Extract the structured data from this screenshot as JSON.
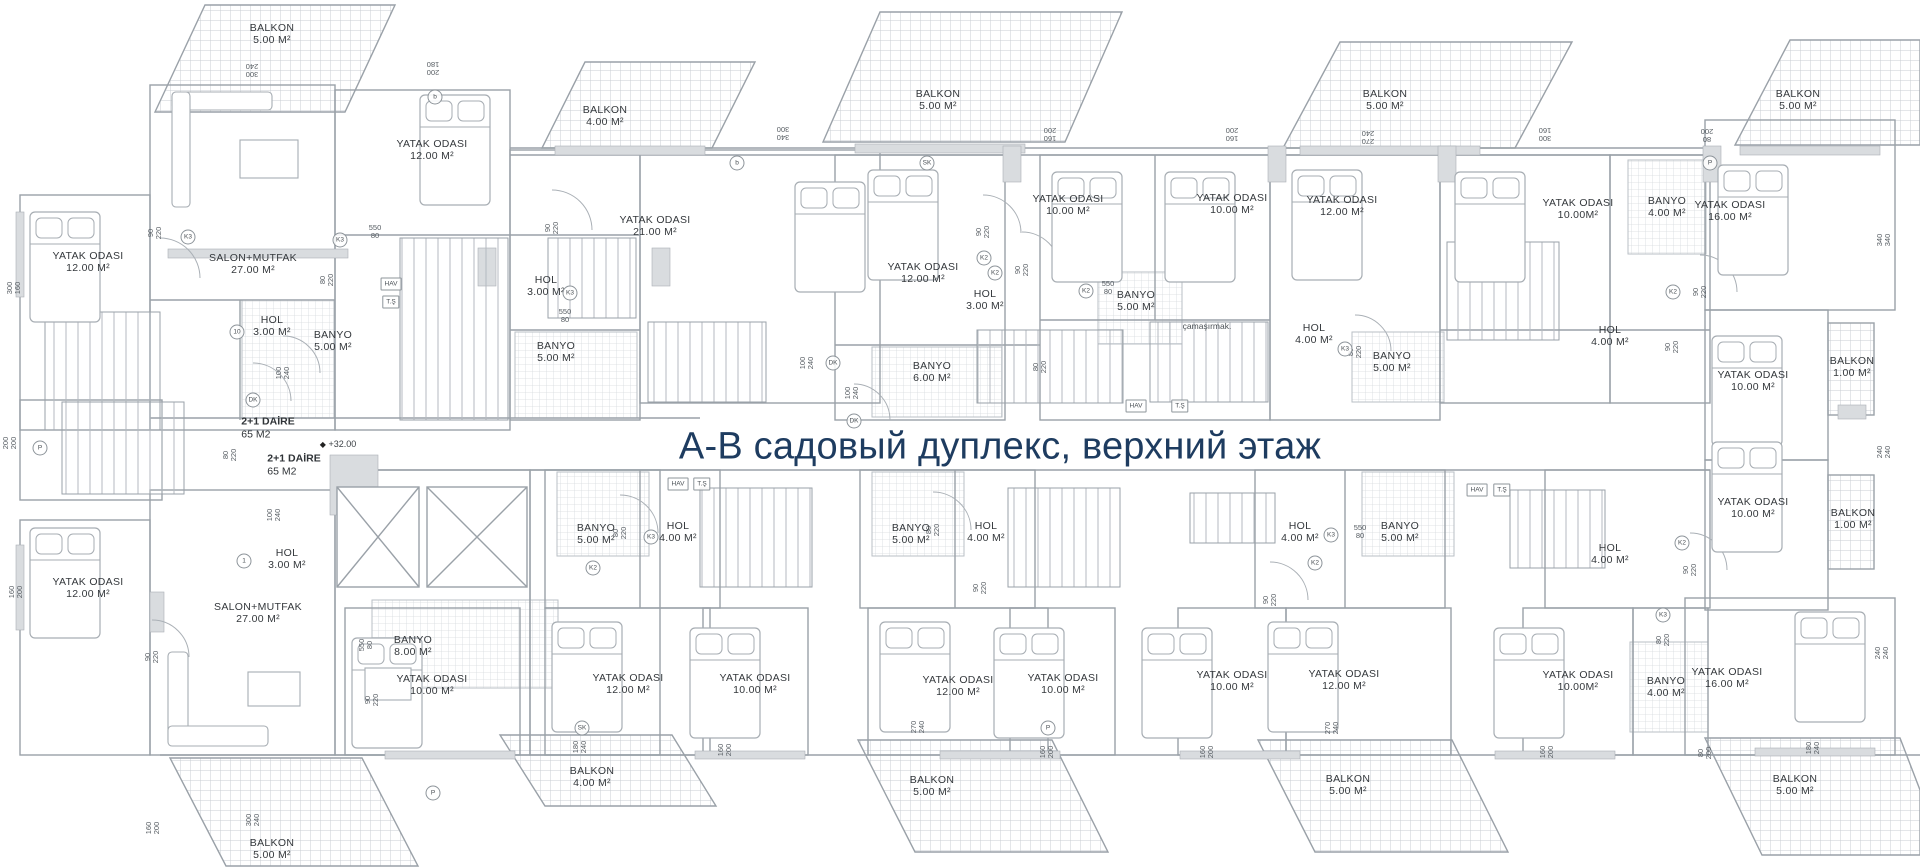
{
  "title": {
    "text": "А-В садовый дуплекс, верхний этаж",
    "color": "#1e3c60"
  },
  "plan": {
    "line_color": "#9aa1a8",
    "hatch_color": "#c9ced3",
    "rooms": [
      {
        "name": "BALKON",
        "area": "5.00 M²",
        "x": 272,
        "y": 34
      },
      {
        "name": "YATAK ODASI",
        "area": "12.00 M²",
        "x": 432,
        "y": 150
      },
      {
        "name": "BALKON",
        "area": "4.00 M²",
        "x": 605,
        "y": 116
      },
      {
        "name": "YATAK ODASI",
        "area": "21.00 M²",
        "x": 655,
        "y": 226
      },
      {
        "name": "YATAK ODASI",
        "area": "12.00 M²",
        "x": 88,
        "y": 262
      },
      {
        "name": "SALON+MUTFAK",
        "area": "27.00 M²",
        "x": 253,
        "y": 264
      },
      {
        "name": "HOL",
        "area": "3.00 M²",
        "x": 272,
        "y": 326
      },
      {
        "name": "BANYO",
        "area": "5.00 M²",
        "x": 333,
        "y": 341
      },
      {
        "name": "HOL",
        "area": "3.00 M²",
        "x": 546,
        "y": 286
      },
      {
        "name": "BANYO",
        "area": "5.00 M²",
        "x": 556,
        "y": 352
      },
      {
        "name": "BALKON",
        "area": "5.00 M²",
        "x": 938,
        "y": 100
      },
      {
        "name": "YATAK ODASI",
        "area": "12.00 M²",
        "x": 923,
        "y": 273
      },
      {
        "name": "HOL",
        "area": "3.00 M²",
        "x": 985,
        "y": 300
      },
      {
        "name": "BANYO",
        "area": "6.00 M²",
        "x": 932,
        "y": 372
      },
      {
        "name": "YATAK ODASI",
        "area": "10.00 M²",
        "x": 1068,
        "y": 205
      },
      {
        "name": "YATAK ODASI",
        "area": "10.00 M²",
        "x": 1232,
        "y": 204
      },
      {
        "name": "BANYO",
        "area": "5.00 M²",
        "x": 1136,
        "y": 301
      },
      {
        "name": "BALKON",
        "area": "5.00 M²",
        "x": 1385,
        "y": 100
      },
      {
        "name": "YATAK ODASI",
        "area": "12.00 M²",
        "x": 1342,
        "y": 206
      },
      {
        "name": "HOL",
        "area": "4.00 M²",
        "x": 1314,
        "y": 334
      },
      {
        "name": "BANYO",
        "area": "5.00 M²",
        "x": 1392,
        "y": 362
      },
      {
        "name": "YATAK ODASI",
        "area": "10.00M²",
        "x": 1578,
        "y": 209
      },
      {
        "name": "BANYO",
        "area": "4.00 M²",
        "x": 1667,
        "y": 207
      },
      {
        "name": "YATAK ODASI",
        "area": "16.00 M²",
        "x": 1730,
        "y": 211
      },
      {
        "name": "BALKON",
        "area": "5.00 M²",
        "x": 1798,
        "y": 100
      },
      {
        "name": "HOL",
        "area": "4.00 M²",
        "x": 1610,
        "y": 336
      },
      {
        "name": "YATAK ODASI",
        "area": "10.00 M²",
        "x": 1753,
        "y": 381
      },
      {
        "name": "BALKON",
        "area": "1.00 M²",
        "x": 1852,
        "y": 367
      },
      {
        "name": "YATAK ODASI",
        "area": "10.00 M²",
        "x": 1753,
        "y": 508
      },
      {
        "name": "BALKON",
        "area": "1.00 M²",
        "x": 1853,
        "y": 519
      },
      {
        "name": "HOL",
        "area": "3.00 M²",
        "x": 287,
        "y": 559
      },
      {
        "name": "YATAK ODASI",
        "area": "12.00 M²",
        "x": 88,
        "y": 588
      },
      {
        "name": "SALON+MUTFAK",
        "area": "27.00 M²",
        "x": 258,
        "y": 613
      },
      {
        "name": "BANYO",
        "area": "8.00 M²",
        "x": 413,
        "y": 646
      },
      {
        "name": "YATAK ODASI",
        "area": "10.00 M²",
        "x": 432,
        "y": 685
      },
      {
        "name": "BANYO",
        "area": "5.00 M²",
        "x": 596,
        "y": 534
      },
      {
        "name": "HOL",
        "area": "4.00 M²",
        "x": 678,
        "y": 532
      },
      {
        "name": "YATAK ODASI",
        "area": "12.00 M²",
        "x": 628,
        "y": 684
      },
      {
        "name": "YATAK ODASI",
        "area": "10.00 M²",
        "x": 755,
        "y": 684
      },
      {
        "name": "BANYO",
        "area": "5.00 M²",
        "x": 911,
        "y": 534
      },
      {
        "name": "HOL",
        "area": "4.00 M²",
        "x": 986,
        "y": 532
      },
      {
        "name": "YATAK ODASI",
        "area": "12.00 M²",
        "x": 958,
        "y": 686
      },
      {
        "name": "YATAK ODASI",
        "area": "10.00 M²",
        "x": 1063,
        "y": 684
      },
      {
        "name": "HOL",
        "area": "4.00 M²",
        "x": 1300,
        "y": 532
      },
      {
        "name": "BANYO",
        "area": "5.00 M²",
        "x": 1400,
        "y": 532
      },
      {
        "name": "YATAK ODASI",
        "area": "10.00 M²",
        "x": 1232,
        "y": 681
      },
      {
        "name": "YATAK ODASI",
        "area": "12.00 M²",
        "x": 1344,
        "y": 680
      },
      {
        "name": "HOL",
        "area": "4.00 M²",
        "x": 1610,
        "y": 554
      },
      {
        "name": "YATAK ODASI",
        "area": "10.00M²",
        "x": 1578,
        "y": 681
      },
      {
        "name": "BANYO",
        "area": "4.00 M²",
        "x": 1666,
        "y": 687
      },
      {
        "name": "YATAK ODASI",
        "area": "16.00 M²",
        "x": 1727,
        "y": 678
      },
      {
        "name": "BALKON",
        "area": "5.00 M²",
        "x": 272,
        "y": 849
      },
      {
        "name": "BALKON",
        "area": "4.00 M²",
        "x": 592,
        "y": 777
      },
      {
        "name": "BALKON",
        "area": "5.00 M²",
        "x": 932,
        "y": 786
      },
      {
        "name": "BALKON",
        "area": "5.00 M²",
        "x": 1348,
        "y": 785
      },
      {
        "name": "BALKON",
        "area": "5.00 M²",
        "x": 1795,
        "y": 785
      }
    ],
    "units": [
      {
        "label": "2+1 DAİRE",
        "size": "65 M2",
        "x": 268,
        "y": 428
      },
      {
        "label": "2+1 DAİRE",
        "size": "65 M2",
        "x": 294,
        "y": 465
      }
    ],
    "elevation": {
      "symbol": "◆",
      "text": "+32.00",
      "x": 338,
      "y": 444
    },
    "texts": [
      {
        "t": "çamaşırmak.",
        "x": 1207,
        "y": 326
      }
    ],
    "dims": [
      {
        "a": "90",
        "b": "220",
        "x": 155,
        "y": 233,
        "r": "v"
      },
      {
        "a": "550",
        "b": "80",
        "x": 375,
        "y": 232,
        "r": ""
      },
      {
        "a": "80",
        "b": "220",
        "x": 327,
        "y": 280,
        "r": "v"
      },
      {
        "a": "100",
        "b": "240",
        "x": 283,
        "y": 373,
        "r": "v"
      },
      {
        "a": "90",
        "b": "220",
        "x": 552,
        "y": 228,
        "r": "v"
      },
      {
        "a": "550",
        "b": "80",
        "x": 565,
        "y": 316,
        "r": ""
      },
      {
        "a": "100",
        "b": "240",
        "x": 807,
        "y": 363,
        "r": "v"
      },
      {
        "a": "100",
        "b": "240",
        "x": 852,
        "y": 393,
        "r": "v"
      },
      {
        "a": "80",
        "b": "220",
        "x": 1040,
        "y": 367,
        "r": "v"
      },
      {
        "a": "90",
        "b": "220",
        "x": 983,
        "y": 232,
        "r": "v"
      },
      {
        "a": "90",
        "b": "220",
        "x": 1022,
        "y": 270,
        "r": "v"
      },
      {
        "a": "550",
        "b": "80",
        "x": 1108,
        "y": 288,
        "r": ""
      },
      {
        "a": "80",
        "b": "220",
        "x": 1355,
        "y": 352,
        "r": "v"
      },
      {
        "a": "90",
        "b": "220",
        "x": 1672,
        "y": 347,
        "r": "v"
      },
      {
        "a": "90",
        "b": "220",
        "x": 1700,
        "y": 292,
        "r": "v"
      },
      {
        "a": "340",
        "b": "300",
        "x": 783,
        "y": 133,
        "r": "u"
      },
      {
        "a": "300",
        "b": "240",
        "x": 252,
        "y": 70,
        "r": "u"
      },
      {
        "a": "200",
        "b": "180",
        "x": 433,
        "y": 68,
        "r": "u"
      },
      {
        "a": "160",
        "b": "200",
        "x": 1050,
        "y": 134,
        "r": "u"
      },
      {
        "a": "160",
        "b": "200",
        "x": 1232,
        "y": 134,
        "r": "u"
      },
      {
        "a": "270",
        "b": "240",
        "x": 1368,
        "y": 137,
        "r": "u"
      },
      {
        "a": "300",
        "b": "160",
        "x": 1545,
        "y": 134,
        "r": "u"
      },
      {
        "a": "80",
        "b": "200",
        "x": 1707,
        "y": 135,
        "r": "u"
      },
      {
        "a": "300",
        "b": "160",
        "x": 14,
        "y": 288,
        "r": "v"
      },
      {
        "a": "200",
        "b": "200",
        "x": 10,
        "y": 443,
        "r": "v"
      },
      {
        "a": "160",
        "b": "200",
        "x": 16,
        "y": 592,
        "r": "v"
      },
      {
        "a": "340",
        "b": "340",
        "x": 1884,
        "y": 240,
        "r": "v"
      },
      {
        "a": "240",
        "b": "240",
        "x": 1884,
        "y": 452,
        "r": "v"
      },
      {
        "a": "240",
        "b": "240",
        "x": 1882,
        "y": 653,
        "r": "v"
      },
      {
        "a": "90",
        "b": "220",
        "x": 152,
        "y": 657,
        "r": "v"
      },
      {
        "a": "80",
        "b": "220",
        "x": 230,
        "y": 455,
        "r": "v"
      },
      {
        "a": "100",
        "b": "240",
        "x": 274,
        "y": 515,
        "r": "v"
      },
      {
        "a": "550",
        "b": "80",
        "x": 366,
        "y": 645,
        "r": "v"
      },
      {
        "a": "90",
        "b": "220",
        "x": 372,
        "y": 700,
        "r": "v"
      },
      {
        "a": "80",
        "b": "220",
        "x": 620,
        "y": 533,
        "r": "v"
      },
      {
        "a": "80",
        "b": "220",
        "x": 933,
        "y": 530,
        "r": "v"
      },
      {
        "a": "90",
        "b": "220",
        "x": 980,
        "y": 588,
        "r": "v"
      },
      {
        "a": "90",
        "b": "220",
        "x": 1270,
        "y": 600,
        "r": "v"
      },
      {
        "a": "550",
        "b": "80",
        "x": 1360,
        "y": 532,
        "r": ""
      },
      {
        "a": "90",
        "b": "220",
        "x": 1690,
        "y": 570,
        "r": "v"
      },
      {
        "a": "80",
        "b": "220",
        "x": 1663,
        "y": 640,
        "r": "v"
      },
      {
        "a": "300",
        "b": "240",
        "x": 253,
        "y": 820,
        "r": "v"
      },
      {
        "a": "160",
        "b": "200",
        "x": 153,
        "y": 828,
        "r": "v"
      },
      {
        "a": "180",
        "b": "240",
        "x": 580,
        "y": 747,
        "r": "v"
      },
      {
        "a": "160",
        "b": "200",
        "x": 725,
        "y": 750,
        "r": "v"
      },
      {
        "a": "270",
        "b": "240",
        "x": 918,
        "y": 727,
        "r": "v"
      },
      {
        "a": "160",
        "b": "200",
        "x": 1047,
        "y": 752,
        "r": "v"
      },
      {
        "a": "160",
        "b": "200",
        "x": 1207,
        "y": 752,
        "r": "v"
      },
      {
        "a": "270",
        "b": "240",
        "x": 1332,
        "y": 728,
        "r": "v"
      },
      {
        "a": "160",
        "b": "200",
        "x": 1547,
        "y": 752,
        "r": "v"
      },
      {
        "a": "80",
        "b": "200",
        "x": 1705,
        "y": 753,
        "r": "v"
      },
      {
        "a": "180",
        "b": "240",
        "x": 1813,
        "y": 748,
        "r": "v"
      }
    ],
    "markers": [
      {
        "t": "10",
        "x": 237,
        "y": 332,
        "s": "c"
      },
      {
        "t": "1",
        "x": 244,
        "y": 561,
        "s": "c"
      },
      {
        "t": "DK",
        "x": 253,
        "y": 400,
        "s": "c"
      },
      {
        "t": "DK",
        "x": 833,
        "y": 363,
        "s": "c"
      },
      {
        "t": "DK",
        "x": 854,
        "y": 421,
        "s": "c"
      },
      {
        "t": "K3",
        "x": 188,
        "y": 237,
        "s": "c"
      },
      {
        "t": "K3",
        "x": 340,
        "y": 240,
        "s": "c"
      },
      {
        "t": "K3",
        "x": 570,
        "y": 293,
        "s": "c"
      },
      {
        "t": "K2",
        "x": 984,
        "y": 258,
        "s": "c"
      },
      {
        "t": "K2",
        "x": 995,
        "y": 273,
        "s": "c"
      },
      {
        "t": "K2",
        "x": 1086,
        "y": 291,
        "s": "c"
      },
      {
        "t": "K3",
        "x": 1345,
        "y": 349,
        "s": "c"
      },
      {
        "t": "K2",
        "x": 1673,
        "y": 292,
        "s": "c"
      },
      {
        "t": "K2",
        "x": 1682,
        "y": 543,
        "s": "c"
      },
      {
        "t": "K3",
        "x": 1663,
        "y": 615,
        "s": "c"
      },
      {
        "t": "K3",
        "x": 651,
        "y": 537,
        "s": "c"
      },
      {
        "t": "K2",
        "x": 593,
        "y": 568,
        "s": "c"
      },
      {
        "t": "K3",
        "x": 1331,
        "y": 535,
        "s": "c"
      },
      {
        "t": "K2",
        "x": 1315,
        "y": 563,
        "s": "c"
      },
      {
        "t": "P",
        "x": 40,
        "y": 448,
        "s": "c"
      },
      {
        "t": "P",
        "x": 433,
        "y": 793,
        "s": "c"
      },
      {
        "t": "P",
        "x": 1048,
        "y": 728,
        "s": "c"
      },
      {
        "t": "P",
        "x": 1710,
        "y": 163,
        "s": "c"
      },
      {
        "t": "SK",
        "x": 927,
        "y": 163,
        "s": "c"
      },
      {
        "t": "SK",
        "x": 582,
        "y": 728,
        "s": "c"
      },
      {
        "t": "b",
        "x": 435,
        "y": 97,
        "s": "c"
      },
      {
        "t": "b",
        "x": 737,
        "y": 163,
        "s": "c"
      },
      {
        "t": "HAV",
        "x": 391,
        "y": 284,
        "s": "b"
      },
      {
        "t": "T.Ş",
        "x": 391,
        "y": 302,
        "s": "b"
      },
      {
        "t": "HAV",
        "x": 1136,
        "y": 406,
        "s": "b"
      },
      {
        "t": "T.Ş",
        "x": 1180,
        "y": 406,
        "s": "b"
      },
      {
        "t": "HAV",
        "x": 1477,
        "y": 490,
        "s": "b"
      },
      {
        "t": "T.Ş",
        "x": 1502,
        "y": 490,
        "s": "b"
      },
      {
        "t": "HAV",
        "x": 678,
        "y": 484,
        "s": "b"
      },
      {
        "t": "T.Ş",
        "x": 702,
        "y": 484,
        "s": "b"
      }
    ]
  }
}
